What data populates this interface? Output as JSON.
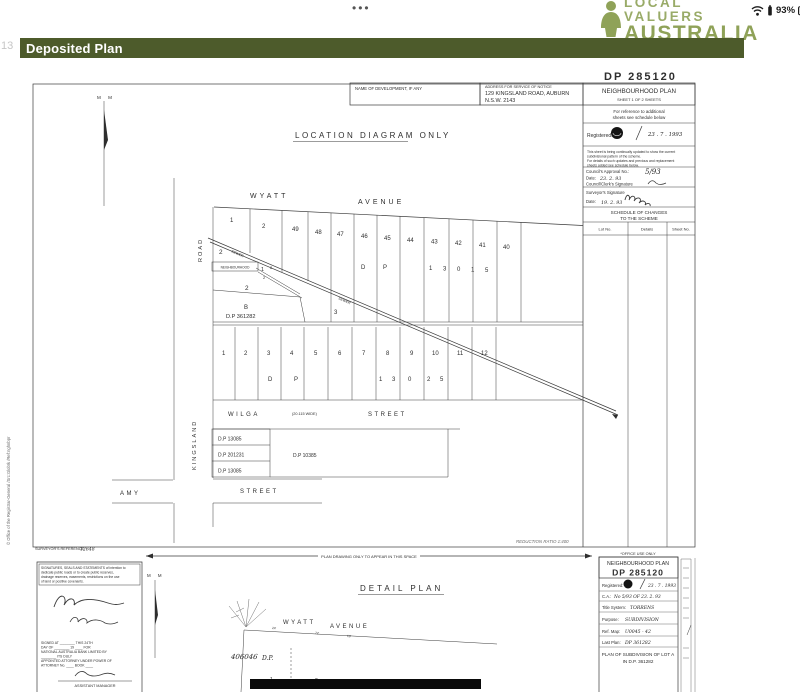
{
  "colors": {
    "header_bar": "#4d5b2b",
    "brand_green": "#8fa258",
    "scan_ink": "#2e2e2e"
  },
  "status_bar": {
    "menu_dots": "•••",
    "brand": {
      "line1": "LOCAL VALUERS",
      "line2": "AUSTRALIA"
    },
    "battery_percent": "93%"
  },
  "page": {
    "margin_number": "13"
  },
  "header": {
    "title": "Deposited Plan"
  },
  "sheet1": {
    "dp_stamp": "DP 285120",
    "boxes": {
      "name_of_development": "NAME OF DEVELOPMENT, IF ANY",
      "address_label": "ADDRESS FOR SERVICE OF NOTICE",
      "address_line1": "129  KINGSLAND   ROAD,  AUBURN",
      "address_line2": "N.S.W.   2143",
      "plan_type": "NEIGHBOURHOOD  PLAN",
      "sheet_note": "SHEET 1  OF  2  SHEETS"
    },
    "panel": {
      "reference_note_line1": "For reference to additional",
      "reference_note_line2": "sheets see schedule below",
      "registered_label": "Registered:",
      "registered_date": "23 . 7 . 1993",
      "update_note_lines": [
        "This sheet is being continually updated to show the current",
        "subdivisional pattern of the scheme.",
        "For details of such updates and previous and replacement",
        "sheets added see schedule below."
      ],
      "council_approval_label": "Council's Approval No.:",
      "council_approval_no": "5/93",
      "date_label": "Date:",
      "council_date": "23. 2. 93",
      "council_clerk_label": "Council/Clerk's Signature",
      "surveyor_label": "Surveyor's Signature",
      "surveyor_date": "19. 2. 93",
      "schedule_title_line1": "SCHEDULE OF CHANGES",
      "schedule_title_line2": "TO THE SCHEME",
      "columns": [
        "Lot No.",
        "Details",
        "Sheet No."
      ]
    },
    "diagram": {
      "north_mark": "M  M",
      "title": "LOCATION  DIAGRAM  ONLY",
      "wyatt": "WYATT",
      "avenue": "AVENUE",
      "road": "ROAD",
      "kingsland": "KINGSLAND",
      "wilga": "WILGA",
      "wilga_width": "(20.115 WIDE)",
      "wilga_street": "STREET",
      "amy": "AMY",
      "amy_street": "STREET",
      "lot_row1": [
        "1",
        "2",
        "49",
        "48",
        "47",
        "46",
        "45",
        "44",
        "43",
        "42",
        "41",
        "40"
      ],
      "row1_dp": [
        "D",
        "P",
        "1",
        "3",
        "0",
        "1",
        "5"
      ],
      "lot_row2": [
        "1",
        "2",
        "3",
        "4",
        "5",
        "6",
        "7",
        "8",
        "9",
        "10",
        "11",
        "12"
      ],
      "row2_dp": [
        "D",
        "P",
        "1",
        "3",
        "0",
        "2",
        "5"
      ],
      "part_lot_2a": "2",
      "part_lot_1": "1",
      "part_lot_2b": "2",
      "part_lot_2c": "2",
      "part_lot_2d": "2",
      "neighbourhood_label": "NEIGHBOURHOOD",
      "lot_b": "B",
      "dp_361282": "D.P    361282",
      "lot_3": "3",
      "sewer_label_1": "SEWER",
      "sewer_label_2": "SEWER",
      "dp_box_rows": [
        "D.P    13085",
        "D.P    201231",
        "D.P    13085"
      ],
      "dp_box_right": "D.P    10385",
      "reduction_ratio": "REDUCTION RATIO  1:400"
    },
    "footer": {
      "surveyors_reference": "SURVEYOR'S REFERENCE:",
      "surveyors_reference_no": "12648",
      "registrar_note": "© Office of the Registrar-General  /Src:GlobIk  /Ref:nghnbpr"
    }
  },
  "divider": {
    "note": "PLAN DRAWING ONLY TO APPEAR IN THIS SPACE"
  },
  "sheet2": {
    "statement_lines": [
      "SIGNATURES, SEALS AND STATEMENTS of intention to",
      "dedicate public roads or to create public reserves,",
      "drainage reserves, easements, restrictions on the use",
      "of land or positive covenants."
    ],
    "signed_lines": [
      "SIGNED AT ________ THIS  24TH",
      "DAY OF ________  19 ____  FOR",
      "NATIONAL AUSTRALIA BANK LIMITED BY",
      "________  ITS DULY",
      "APPOINTED ATTORNEY UNDER POWER OF",
      "ATTORNEY No.  ____   BOOK  ____"
    ],
    "assistant_manager": "ASSISTANT MANAGER",
    "north_mark": "M  M",
    "title": "DETAIL  PLAN",
    "wyatt": "WYATT",
    "avenue": "AVENUE",
    "street_ticks": [
      "24'",
      "72'",
      "10'"
    ],
    "dp_label": "D.P.",
    "dp_number": "406046",
    "lot_1": "1",
    "lot_2": "2",
    "office_use": "*OFFICE USE ONLY",
    "panel": {
      "plan_type": "NEIGHBOURHOOD  PLAN",
      "dp_number": "DP 285120",
      "registered_label": "Registered:",
      "registered_date": "23 . 7 . 1993",
      "ca_label": "C.A.:",
      "ca_value": "No 5/93 OF 23. 2. 93",
      "title_system_label": "Title System:",
      "title_system_value": "TORRENS",
      "purpose_label": "Purpose:",
      "purpose_value": "SUBDIVISION",
      "ref_map_label": "Ref. Map:",
      "ref_map_value": "U0045 - 42",
      "last_plan_label": "Last Plan:",
      "last_plan_value": "DP 361282",
      "plan_of_line1": "PLAN OF SUBDIVISION OF LOT A",
      "plan_of_line2": "IN  D.P. 361282"
    }
  }
}
